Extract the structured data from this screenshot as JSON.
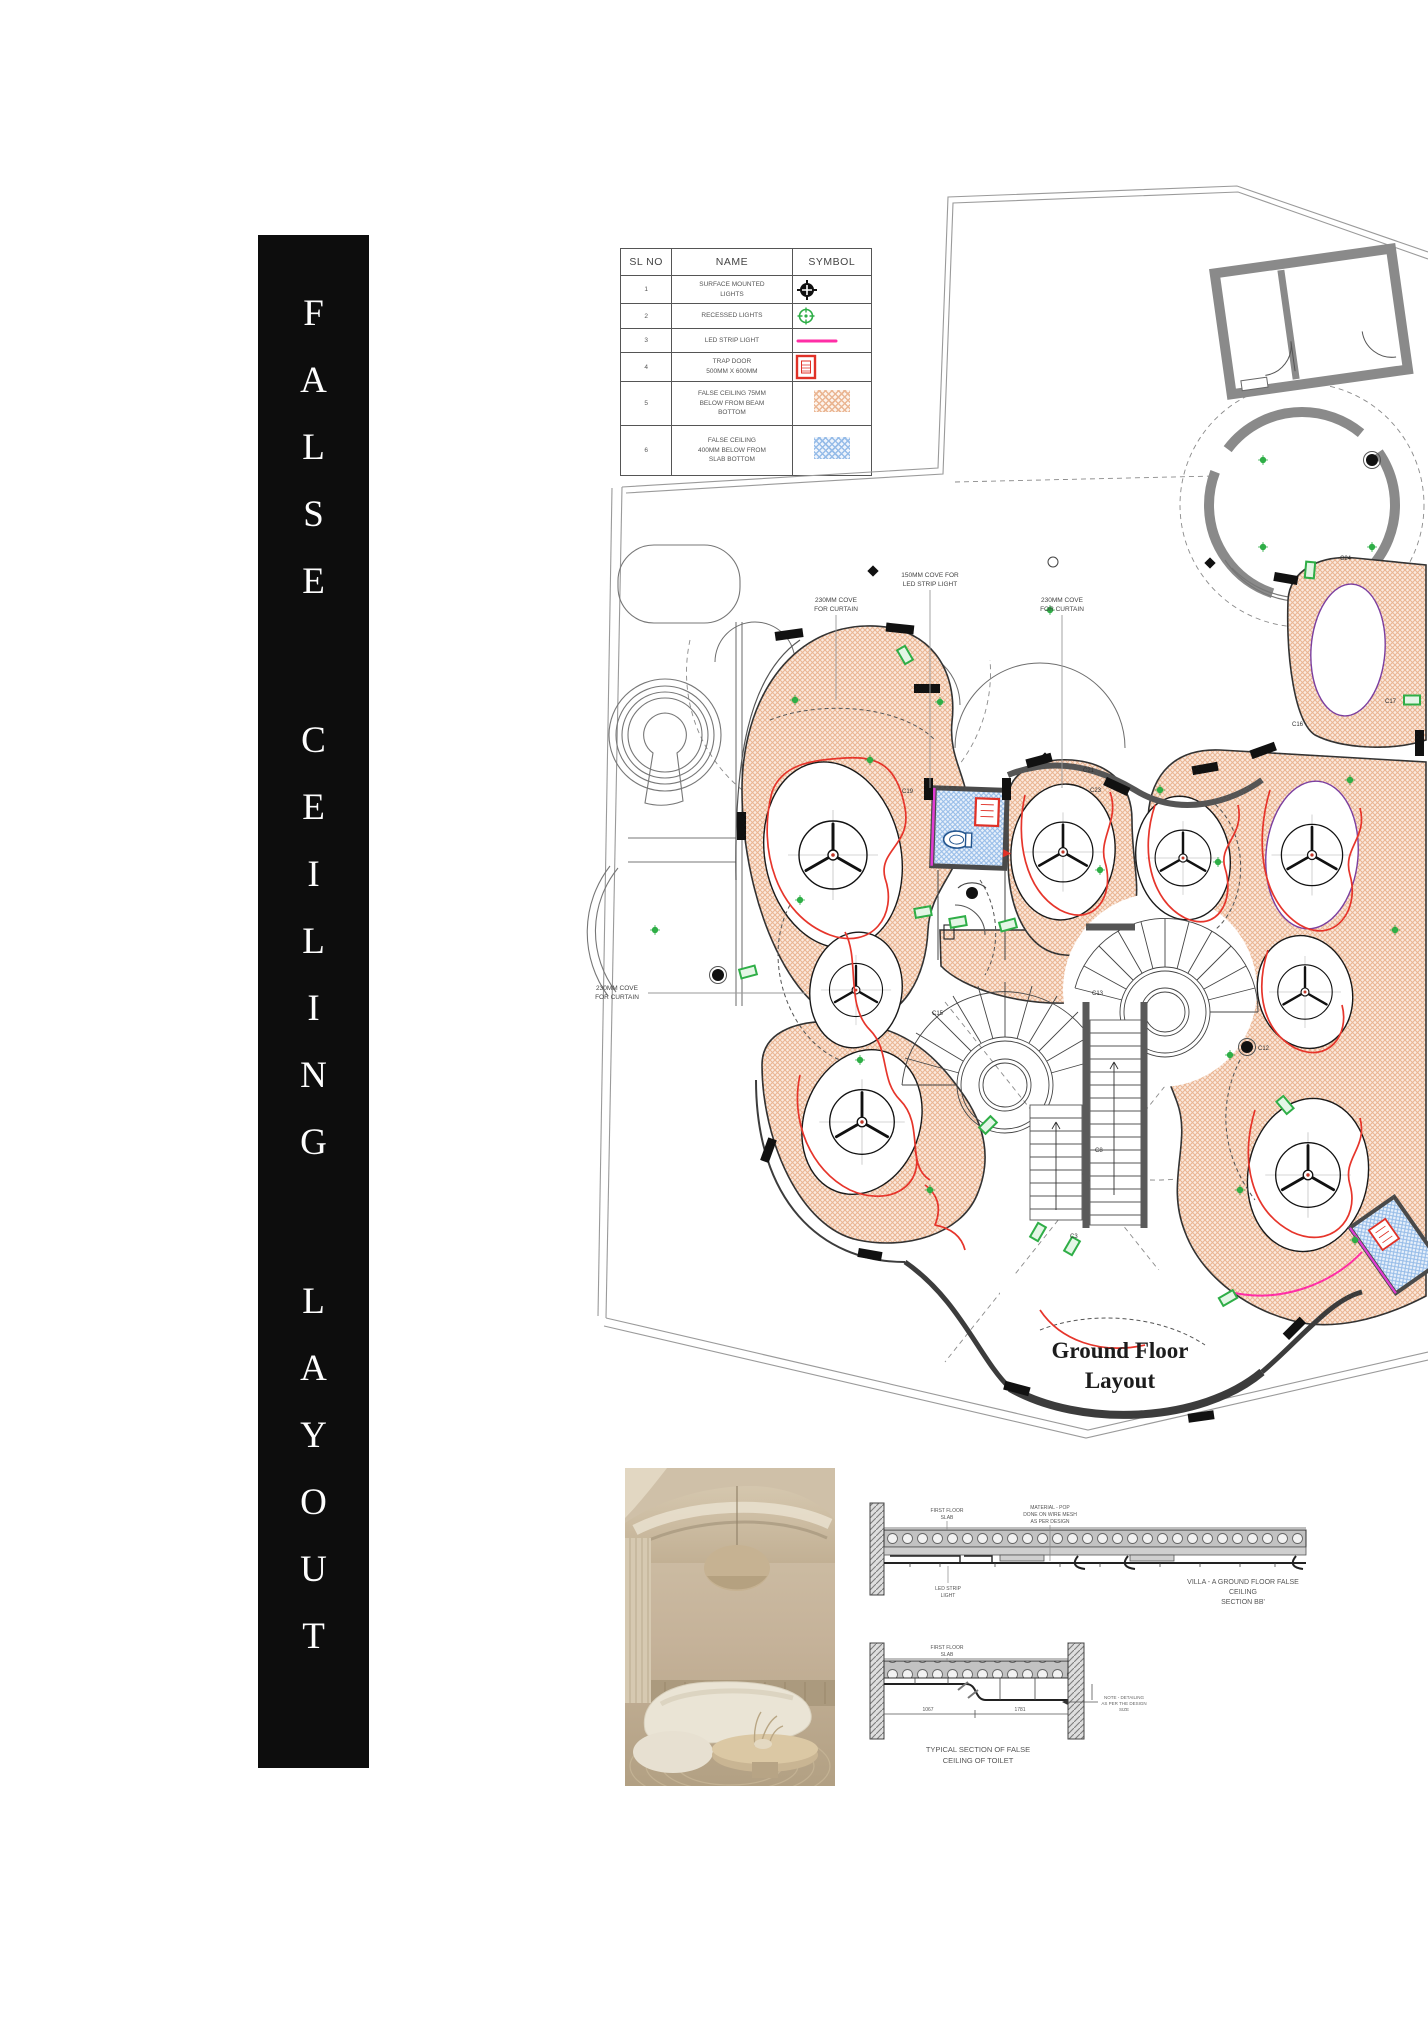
{
  "banner": {
    "word1": "FALSE",
    "word2": "CEILING",
    "word3": "LAYOUT"
  },
  "legend": {
    "header": {
      "sl_no": "SL NO",
      "name": "NAME",
      "symbol": "SYMBOL"
    },
    "rows": [
      {
        "no": "1",
        "name": "SURFACE MOUNTED\nLIGHTS"
      },
      {
        "no": "2",
        "name": "RECESSED LIGHTS"
      },
      {
        "no": "3",
        "name": "LED STRIP LIGHT"
      },
      {
        "no": "4",
        "name": "TRAP DOOR\n500MM X 600MM"
      },
      {
        "no": "5",
        "name": "FALSE CEILING 75MM\nBELOW FROM BEAM\nBOTTOM"
      },
      {
        "no": "6",
        "name": "FALSE CEILING\n400MM BELOW FROM\nSLAB BOTTOM"
      }
    ]
  },
  "plan": {
    "title_line1": "Ground Floor",
    "title_line2": "Layout",
    "ann_cove150_l1": "150MM COVE FOR",
    "ann_cove150_l2": "LED STRIP LIGHT",
    "ann_curtain_l1": "230MM COVE",
    "ann_curtain_l2": "FOR CURTAIN",
    "columns": {
      "c3": "C3",
      "c8": "C8",
      "c12": "C12",
      "c13": "C13",
      "c15": "C15",
      "c16": "C16",
      "c17": "C17",
      "c19": "C19",
      "c21": "C21",
      "c23": "C23",
      "c24": "C24"
    }
  },
  "sections": {
    "bb": {
      "label_slab_l1": "FIRST FLOOR",
      "label_slab_l2": "SLAB",
      "label_material_l1": "MATERIAL - POP",
      "label_material_l2": "DONE ON WIRE MESH",
      "label_material_l3": "AS PER DESIGN",
      "label_led_l1": "LED STRIP",
      "label_led_l2": "LIGHT",
      "caption_l1": "VILLA - A GROUND FLOOR  FALSE",
      "caption_l2": "CEILING",
      "caption_l3": "SECTION BB'"
    },
    "toilet": {
      "label_slab_l1": "FIRST FLOOR",
      "label_slab_l2": "SLAB",
      "dim1": "1067",
      "dim2": "1781",
      "note_l1": "NOTE - DETAILING",
      "note_l2": "AS PER THE DESIGN",
      "note_l3": "SIZE",
      "caption_l1": "TYPICAL SECTION OF FALSE",
      "caption_l2": "CEILING OF TOILET"
    }
  },
  "colors": {
    "salmon_hatch": "#eab693",
    "blue_hatch": "#96bce8",
    "led_red": "#e6352b",
    "led_magenta": "#ff2ea6",
    "green": "#2fae47",
    "wall_dark": "#111111"
  }
}
